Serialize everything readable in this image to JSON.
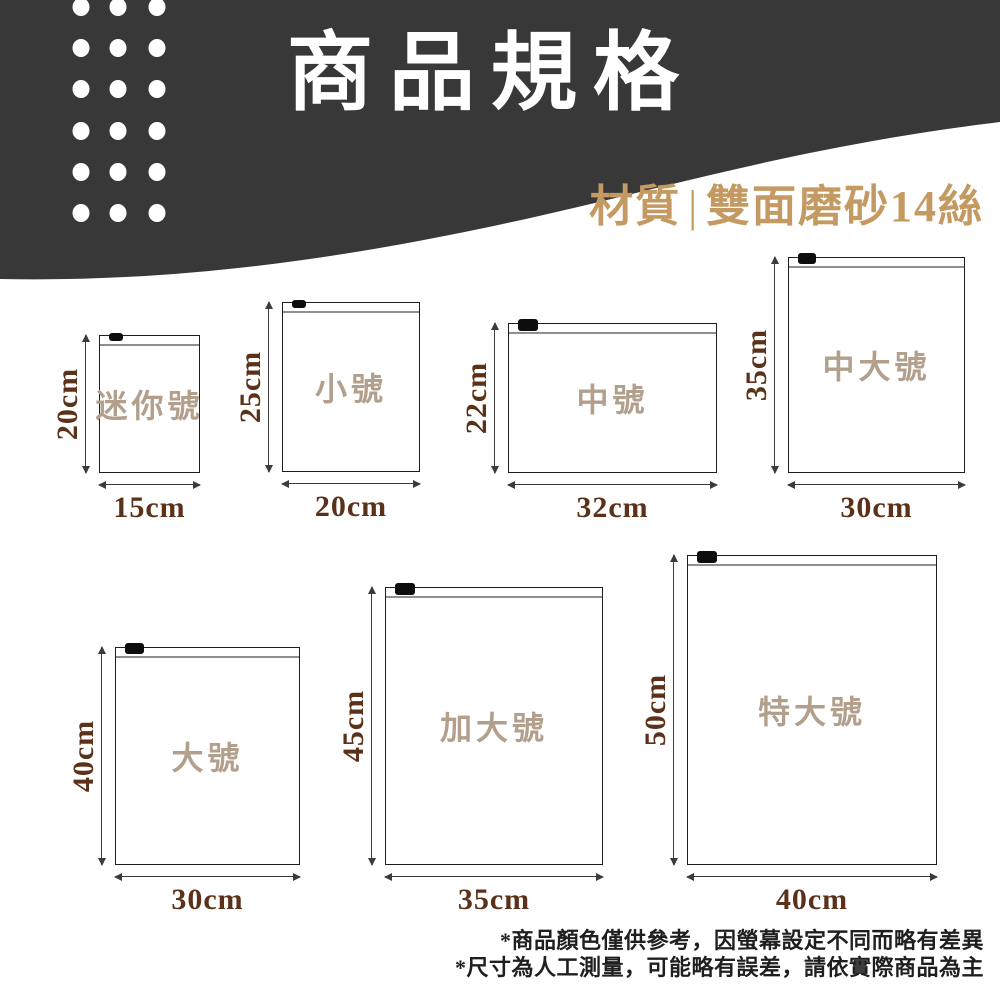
{
  "header": {
    "title": "商品規格",
    "material_label": "材質",
    "material_separator": "|",
    "material_value": "雙面磨砂14絲"
  },
  "bags": [
    {
      "name": "迷你號",
      "height_label": "20cm",
      "width_label": "15cm",
      "height_cm": 20,
      "width_cm": 15,
      "box": {
        "left": 99,
        "top": 335,
        "width": 101,
        "height": 138
      }
    },
    {
      "name": "小號",
      "height_label": "25cm",
      "width_label": "20cm",
      "height_cm": 25,
      "width_cm": 20,
      "box": {
        "left": 282,
        "top": 302,
        "width": 138,
        "height": 170
      }
    },
    {
      "name": "中號",
      "height_label": "22cm",
      "width_label": "32cm",
      "height_cm": 22,
      "width_cm": 32,
      "box": {
        "left": 508,
        "top": 323,
        "width": 209,
        "height": 150
      }
    },
    {
      "name": "中大號",
      "height_label": "35cm",
      "width_label": "30cm",
      "height_cm": 35,
      "width_cm": 30,
      "box": {
        "left": 788,
        "top": 257,
        "width": 177,
        "height": 216
      }
    },
    {
      "name": "大號",
      "height_label": "40cm",
      "width_label": "30cm",
      "height_cm": 40,
      "width_cm": 30,
      "box": {
        "left": 115,
        "top": 647,
        "width": 185,
        "height": 218
      }
    },
    {
      "name": "加大號",
      "height_label": "45cm",
      "width_label": "35cm",
      "height_cm": 45,
      "width_cm": 35,
      "box": {
        "left": 385,
        "top": 587,
        "width": 218,
        "height": 278
      }
    },
    {
      "name": "特大號",
      "height_label": "50cm",
      "width_label": "40cm",
      "height_cm": 50,
      "width_cm": 40,
      "box": {
        "left": 687,
        "top": 555,
        "width": 250,
        "height": 310
      }
    }
  ],
  "footnotes": [
    "*商品顏色僅供參考，因螢幕設定不同而略有差異",
    "*尺寸為人工測量，可能略有誤差，請依實際商品為主"
  ],
  "colors": {
    "header_bg": "#383838",
    "accent_gold": "#c49a62",
    "dimension_text": "#5b3119",
    "bag_name_text": "#b2a08d",
    "footnote_text": "#1f1f1f"
  }
}
